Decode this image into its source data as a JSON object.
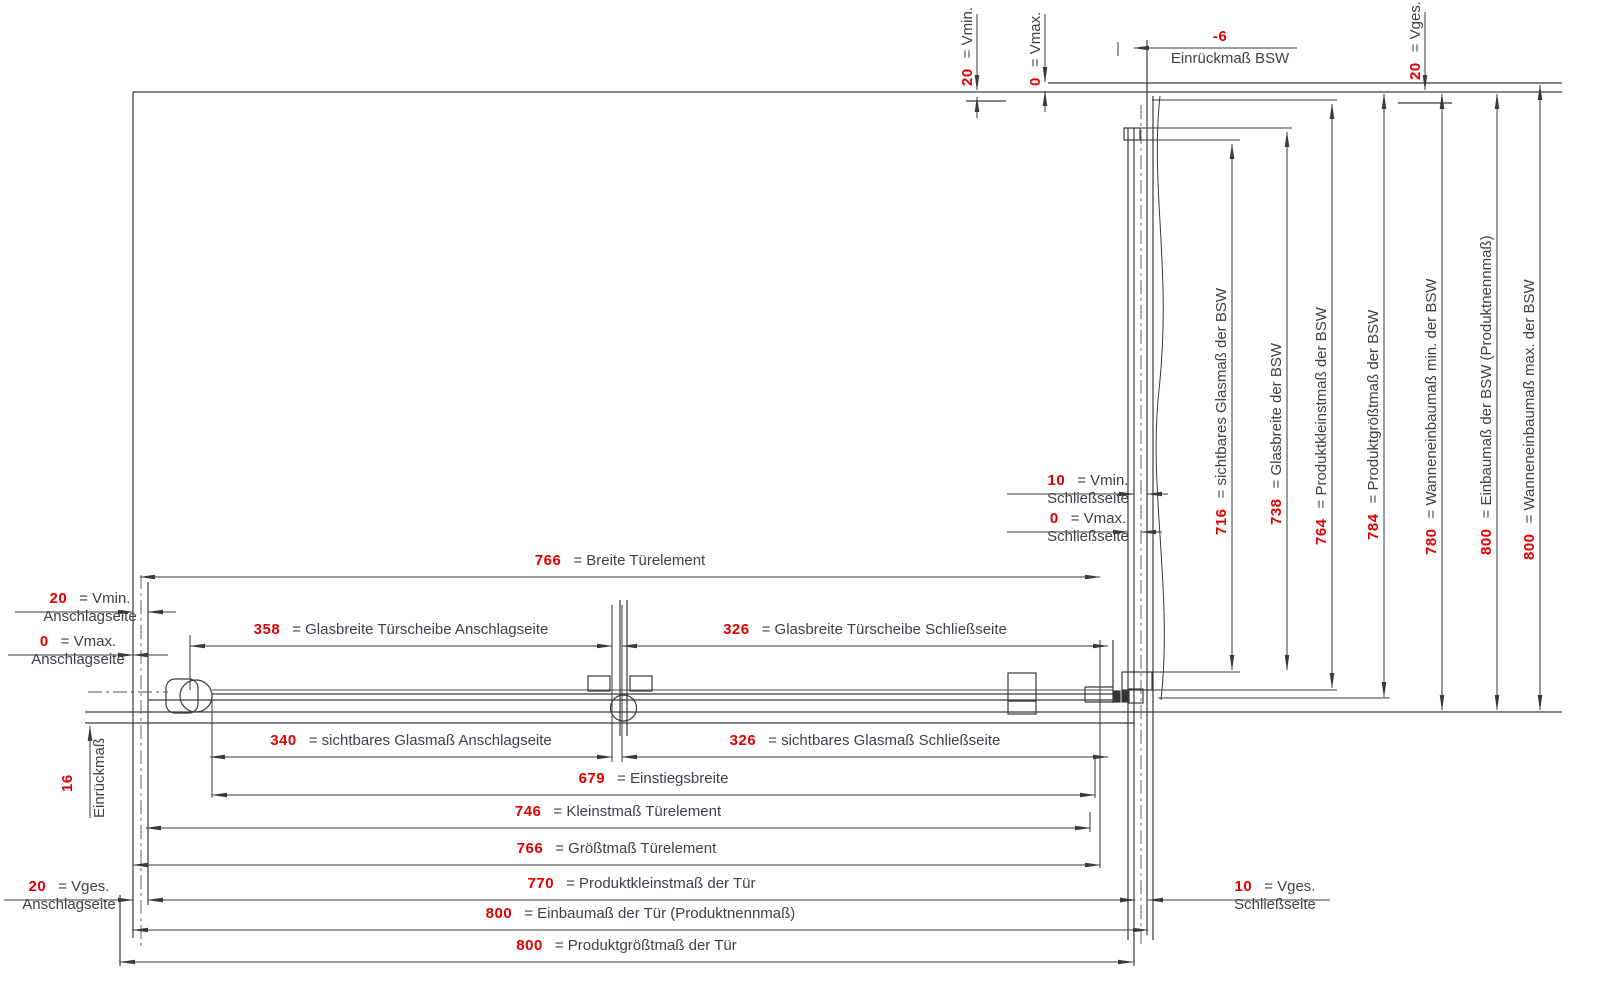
{
  "colors": {
    "dim_value_red": "#e00000",
    "line_dark": "#3a3a3a",
    "text_gray": "#3f4048"
  },
  "top": {
    "vmin": {
      "v": "20",
      "l": "= Vmin."
    },
    "vmax": {
      "v": "0",
      "l": "= Vmax."
    },
    "vges": {
      "v": "20",
      "l": "= Vges."
    },
    "einrueck_bsw": {
      "v": "-6",
      "l": "Einrückmaß BSW"
    }
  },
  "left": {
    "vmin": {
      "v": "20",
      "l": "= Vmin.",
      "s": "Anschlagseite"
    },
    "vmax": {
      "v": "0",
      "l": "= Vmax.",
      "s": "Anschlagseite"
    },
    "vges": {
      "v": "20",
      "l": "= Vges.",
      "s": "Anschlagseite"
    },
    "einrueck": {
      "v": "16",
      "l": "Einrückmaß"
    }
  },
  "right_side": {
    "vmin": {
      "v": "10",
      "l": "= Vmin.",
      "s": "Schließseite"
    },
    "vmax": {
      "v": "0",
      "l": "= Vmax.",
      "s": "Schließseite"
    },
    "vges": {
      "v": "10",
      "l": "= Vges.",
      "s": "Schließseite"
    }
  },
  "bsw_dims": [
    {
      "v": "716",
      "l": "= sichtbares Glasmaß der BSW"
    },
    {
      "v": "738",
      "l": "= Glasbreite der BSW"
    },
    {
      "v": "764",
      "l": "= Produktkleinstmaß der BSW"
    },
    {
      "v": "784",
      "l": "= Produktgrößtmaß der BSW"
    },
    {
      "v": "780",
      "l": "= Wanneneinbaumaß min. der BSW"
    },
    {
      "v": "800",
      "l": "= Einbaumaß der BSW (Produktnennmaß)"
    },
    {
      "v": "800",
      "l": "= Wanneneinbaumaß max. der BSW"
    }
  ],
  "door_dims": [
    {
      "v": "766",
      "l": "= Breite Türelement"
    },
    {
      "v": "358",
      "l": "= Glasbreite Türscheibe Anschlagseite"
    },
    {
      "v": "326",
      "l": "= Glasbreite Türscheibe Schließseite"
    },
    {
      "v": "340",
      "l": "= sichtbares Glasmaß Anschlagseite"
    },
    {
      "v": "326",
      "l": "= sichtbares Glasmaß Schließseite"
    },
    {
      "v": "679",
      "l": "= Einstiegsbreite"
    },
    {
      "v": "746",
      "l": "= Kleinstmaß Türelement"
    },
    {
      "v": "766",
      "l": "= Größtmaß Türelement"
    },
    {
      "v": "770",
      "l": "= Produktkleinstmaß der Tür"
    },
    {
      "v": "800",
      "l": "= Einbaumaß der Tür (Produktnennmaß)"
    },
    {
      "v": "800",
      "l": "= Produktgrößtmaß der Tür"
    }
  ]
}
